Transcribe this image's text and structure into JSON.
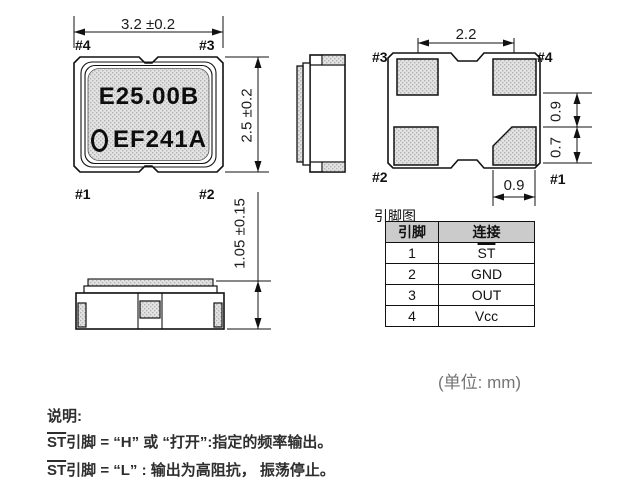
{
  "top_view": {
    "dim_width": "3.2 ±0.2",
    "dim_height": "2.5 ±0.2",
    "pin_tl": "#4",
    "pin_tr": "#3",
    "pin_bl": "#1",
    "pin_br": "#2",
    "marking_line1": "E25.00B",
    "marking_line2": "EF241A"
  },
  "front_view": {
    "dim_height": "1.05 ±0.15"
  },
  "bottom_view": {
    "dim_pad_pitch": "2.2",
    "dim_pad_upper": "0.9",
    "dim_pad_lower": "0.7",
    "dim_pad_width": "0.9",
    "pin_tl": "#3",
    "pin_tr": "#4",
    "pin_bl": "#2",
    "pin_br": "#1"
  },
  "pin_table": {
    "title": "引脚图",
    "col_pin": "引脚",
    "col_conn": "连接",
    "rows": [
      {
        "pin": "1",
        "conn": "ST"
      },
      {
        "pin": "2",
        "conn": "GND"
      },
      {
        "pin": "3",
        "conn": "OUT"
      },
      {
        "pin": "4",
        "conn": "Vcc"
      }
    ]
  },
  "unit_label": "(单位: mm)",
  "notes": {
    "heading": "说明:",
    "line1": {
      "st": "ST",
      "rest": "引脚 = “H” 或 “打开”:指定的频率输出。"
    },
    "line2": {
      "st": "ST",
      "rest": "引脚 = “L” : 输出为高阻抗， 振荡停止。"
    }
  },
  "colors": {
    "line": "#111111",
    "stipple_base": "#e3e3e3",
    "stipple_dot": "#b3b3b3",
    "table_header_bg": "#cbcbcb",
    "unit_text": "#757575"
  }
}
